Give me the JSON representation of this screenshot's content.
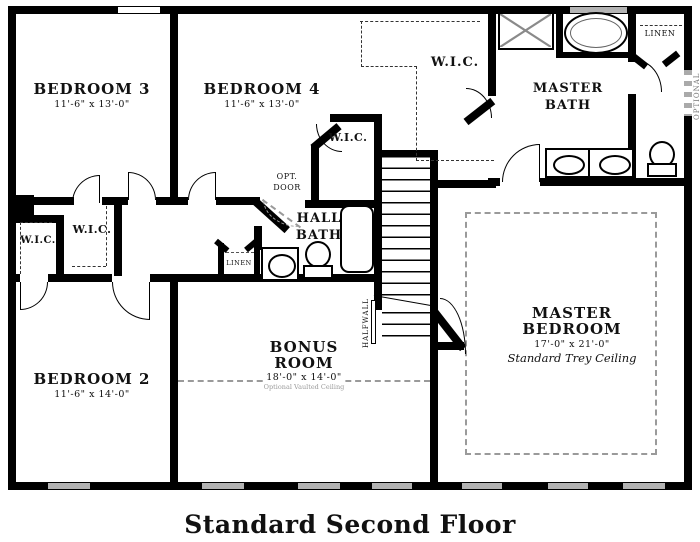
{
  "title": "Standard Second Floor",
  "rooms": {
    "bedroom3": {
      "name": "BEDROOM 3",
      "dims": "11'-6\" x 13'-0\""
    },
    "bedroom4": {
      "name": "BEDROOM 4",
      "dims": "11'-6\" x 13'-0\""
    },
    "bedroom2": {
      "name": "BEDROOM 2",
      "dims": "11'-6\" x 14'-0\""
    },
    "bonus": {
      "line1": "BONUS",
      "line2": "ROOM",
      "dims": "18'-0\" x 14'-0\"",
      "note": "Optional Vaulted Ceiling"
    },
    "master_bedroom": {
      "line1": "MASTER",
      "line2": "BEDROOM",
      "dims": "17'-0\" x 21'-0\"",
      "note": "Standard Trey Ceiling"
    },
    "master_bath": {
      "line1": "MASTER",
      "line2": "BATH"
    },
    "hall_bath": {
      "line1": "HALL",
      "line2": "BATH"
    },
    "wic_master": {
      "label": "W.I.C."
    },
    "wic_bed4": {
      "label": "W.I.C."
    },
    "wic_hall_1": {
      "label": "W.I.C."
    },
    "wic_hall_2": {
      "label": "W.I.C."
    },
    "linen_top": {
      "label": "LINEN"
    },
    "linen_hall": {
      "label": "LINEN"
    }
  },
  "annotations": {
    "opt_door_line1": "OPT.",
    "opt_door_line2": "DOOR",
    "halfwall": "HALFWALL",
    "optional": "OPTIONAL"
  },
  "colors": {
    "wall": "#000000",
    "gray_dash": "#9a9a9a",
    "window_fill": "#b3b3b3",
    "background": "#ffffff"
  }
}
